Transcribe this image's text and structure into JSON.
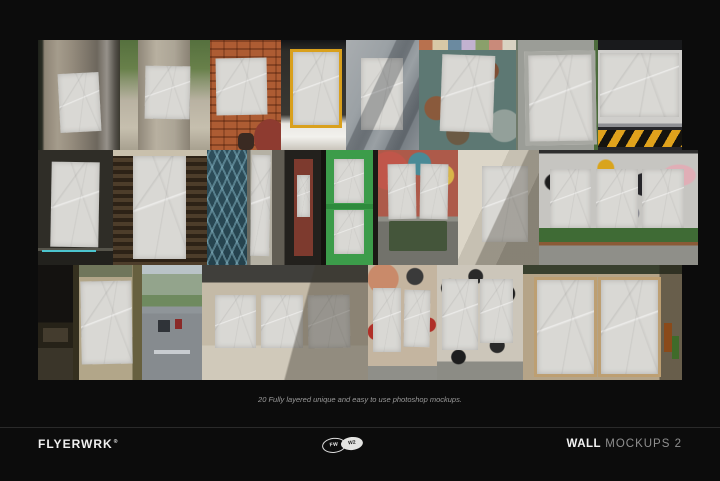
{
  "page": {
    "background": "#0c0c0c"
  },
  "caption": {
    "text": "20 Fully layered unique and easy to use photoshop mockups."
  },
  "footer": {
    "brand": "FLYERWRK",
    "reg": "®",
    "logo_left": "FW",
    "logo_right": "W2",
    "title_bold": "WALL",
    "title_rest": " MOCKUPS 2"
  },
  "colors": {
    "background": "#0c0c0c",
    "caption_text": "#9a9a9a",
    "divider": "#2a2a2a",
    "footer_text": "#f0f0f0",
    "footer_text_muted": "#8f8f8f",
    "poster": "#d9d8d4",
    "hazard_yellow": "#e0a21c",
    "green_door": "#3c9c4a",
    "brick": "#ad5c33",
    "teal_wall": "#5d7873"
  },
  "gallery": {
    "rows": [
      {
        "height": 32.4,
        "tiles": [
          {
            "name": "old-door",
            "w": 12.7,
            "posters": [
              [
                26,
                30,
                50,
                54,
                -3
              ]
            ]
          },
          {
            "name": "concrete-pillar-trees",
            "w": 14.0,
            "posters": [
              [
                28,
                24,
                50,
                48,
                1
              ]
            ]
          },
          {
            "name": "brick-wall",
            "w": 11.0,
            "posters": [
              [
                8,
                16,
                72,
                52,
                -1
              ]
            ],
            "extras": [
              [
                "#8e3b30",
                62,
                72,
                46,
                34,
                50
              ],
              [
                "#3a2a22",
                40,
                84,
                22,
                16,
                30
              ]
            ]
          },
          {
            "name": "yellow-frame-board",
            "w": 10.2,
            "posters": [
              [
                14,
                8,
                70,
                66,
                0
              ]
            ]
          },
          {
            "name": "grey-wall-shadow",
            "w": 11.3,
            "posters": [
              [
                20,
                16,
                58,
                66,
                0
              ]
            ]
          },
          {
            "name": "teal-rust-wall",
            "w": 15.1,
            "posters": [
              [
                22,
                14,
                54,
                70,
                2
              ]
            ]
          },
          {
            "name": "concrete-frame-board",
            "w": 12.6,
            "posters": [
              [
                10,
                10,
                78,
                78,
                -1
              ]
            ]
          },
          {
            "name": "hazard-stripe-wall",
            "w": 13.1,
            "posters": [
              [
                3,
                12,
                94,
                58,
                0
              ]
            ]
          }
        ]
      },
      {
        "height": 33.8,
        "tiles": [
          {
            "name": "dark-wall",
            "w": 11.6,
            "posters": [
              [
                17,
                10,
                64,
                74,
                1
              ]
            ]
          },
          {
            "name": "wood-slat-wall",
            "w": 14.6,
            "posters": [
              [
                22,
                5,
                56,
                90,
                0
              ]
            ]
          },
          {
            "name": "blue-gate",
            "w": 6.2,
            "posters": []
          },
          {
            "name": "pole-poster",
            "w": 4.0,
            "posters": [
              [
                15,
                4,
                72,
                88,
                1
              ]
            ]
          },
          {
            "name": "red-door-storefront",
            "w": 7.5,
            "under": [
              [
                "#7d3a2e",
                44,
                8,
                40,
                84,
                0
              ]
            ],
            "posters": [
              [
                50,
                22,
                28,
                36,
                0
              ]
            ]
          },
          {
            "name": "green-door",
            "w": 8.9,
            "posters": [
              [
                24,
                8,
                52,
                38,
                0
              ],
              [
                24,
                52,
                52,
                38,
                0
              ]
            ]
          },
          {
            "name": "graffiti-wall-bench",
            "w": 12.4,
            "posters": [
              [
                12,
                12,
                35,
                48,
                -1
              ],
              [
                52,
                12,
                35,
                48,
                1
              ]
            ],
            "extras": [
              [
                "#44553a",
                14,
                62,
                72,
                26,
                4
              ]
            ]
          },
          {
            "name": "beige-wall",
            "w": 12.6,
            "posters": [
              [
                30,
                14,
                56,
                66,
                0
              ]
            ]
          },
          {
            "name": "graffiti-mural-plants",
            "w": 24.7,
            "posters": [
              [
                7,
                16,
                26,
                52,
                0
              ],
              [
                36,
                16,
                26,
                52,
                0
              ],
              [
                65,
                16,
                26,
                52,
                0
              ]
            ]
          }
        ]
      },
      {
        "height": 33.8,
        "tiles": [
          {
            "name": "underpass",
            "w": 5.4,
            "posters": [],
            "extras": [
              [
                "#443c2e",
                15,
                55,
                70,
                12,
                2
              ]
            ]
          },
          {
            "name": "pillar-poster",
            "w": 10.7,
            "posters": [
              [
                12,
                14,
                74,
                72,
                -1
              ]
            ]
          },
          {
            "name": "street-view",
            "w": 9.3,
            "posters": [],
            "extras": [
              [
                "#2f3338",
                28,
                48,
                20,
                10,
                3
              ],
              [
                "#8a2a28",
                55,
                47,
                12,
                9,
                3
              ],
              [
                "#c8ccd0",
                20,
                74,
                60,
                3,
                0
              ]
            ]
          },
          {
            "name": "beige-three-posters",
            "w": 25.8,
            "posters": [
              [
                8,
                26,
                25,
                46,
                0
              ],
              [
                36,
                26,
                25,
                46,
                0
              ],
              [
                64,
                26,
                25,
                46,
                -1
              ]
            ]
          },
          {
            "name": "red-graffiti-wall",
            "w": 10.7,
            "posters": [
              [
                8,
                20,
                40,
                56,
                0
              ],
              [
                52,
                22,
                38,
                50,
                1
              ]
            ]
          },
          {
            "name": "bw-graffiti-wall",
            "w": 13.4,
            "posters": [
              [
                6,
                12,
                42,
                62,
                0
              ],
              [
                50,
                12,
                38,
                56,
                0
              ]
            ]
          },
          {
            "name": "double-door-posters",
            "w": 24.7,
            "posters": [
              [
                7,
                10,
                36,
                82,
                0
              ],
              [
                47,
                10,
                36,
                82,
                0
              ]
            ],
            "extras": [
              [
                "#8a4a1a",
                89,
                50,
                5,
                26,
                2
              ],
              [
                "#3f6b2a",
                94,
                62,
                4,
                20,
                2
              ]
            ]
          }
        ]
      }
    ]
  }
}
